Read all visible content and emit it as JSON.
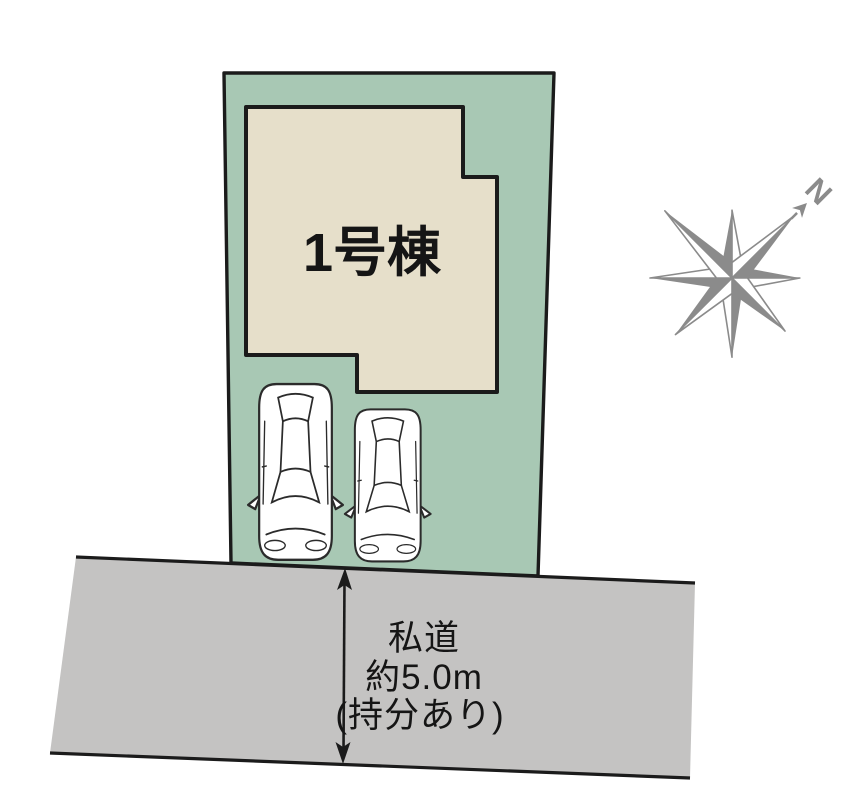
{
  "plot": {
    "building_label": "1号棟"
  },
  "road": {
    "label_line1": "私道",
    "label_line2": "約5.0m",
    "label_line3": "(持分あり)"
  },
  "compass": {
    "north_label": "N"
  },
  "colors": {
    "plot_green": "#a8c8b4",
    "building_beige": "#e6dfca",
    "road_gray": "#c4c3c2",
    "outline_black": "#1b1b1b",
    "compass_gray": "#8b8b8b",
    "car_white": "#ffffff",
    "background": "#ffffff",
    "text_black": "#151515"
  }
}
